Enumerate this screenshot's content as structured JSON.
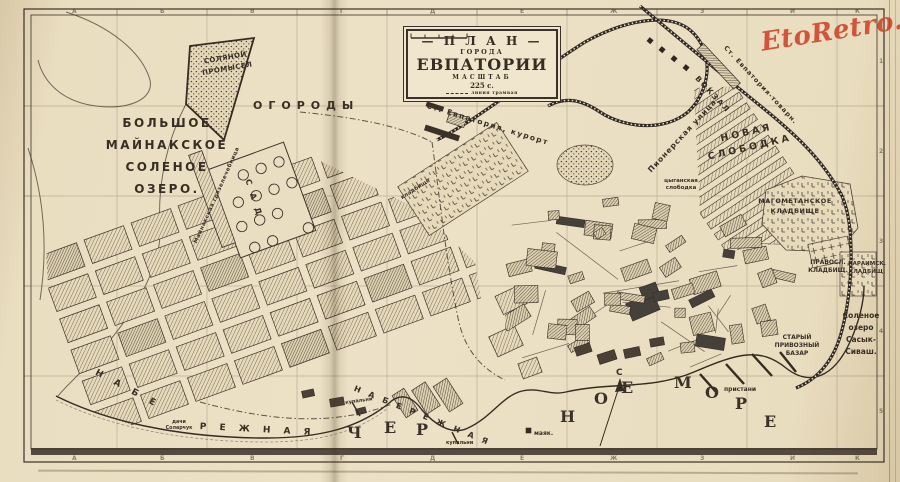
{
  "cartouche": {
    "plan": "— П Л А Н —",
    "goroda": "ГОРОДА",
    "city": "ЕВПАТОРИИ",
    "masshtab": "МАСШТАБ",
    "scale_value": "225 с.",
    "legend_tram": "линия трамвая"
  },
  "watermark": {
    "text": "EtoRetro.ru",
    "color": "#cf4a31"
  },
  "compass": {
    "north": "С"
  },
  "colors": {
    "paper": "#e9ddc0",
    "ink": "#372e23",
    "watermark": "#cf4a31"
  },
  "labels": [
    {
      "name": "lake-bolshoe-maynakskoe",
      "text": "БОЛЬШОЕ\nМАЙНАКСКОЕ\nСОЛЕНОЕ\nОЗЕРО.",
      "x": 92,
      "y": 112,
      "w": 150,
      "size": 12,
      "ls": 2.5,
      "lh": 22
    },
    {
      "name": "solyanoy-promysel",
      "text": "СОЛЯНОЙ\nПРОМЫСЕЛ",
      "x": 196,
      "y": 58,
      "w": 58,
      "size": 7,
      "ls": 0.5,
      "lh": 11,
      "rot": -10
    },
    {
      "name": "ogorody",
      "text": "ОГОРОДЫ",
      "x": 253,
      "y": 99,
      "size": 11,
      "ls": 6
    },
    {
      "name": "st-evpatoriya-kurort",
      "text": "Ст. Евпатория, курорт",
      "x": 428,
      "y": 101,
      "size": 7.5,
      "ls": 1.5,
      "rot": 17
    },
    {
      "name": "st-evpatoriya-tovarn",
      "text": "Ст. Евпатория-товарн.",
      "x": 728,
      "y": 44,
      "size": 6.5,
      "ls": 1,
      "rot": 47
    },
    {
      "name": "vokzal",
      "text": "ВОКЗАЛ",
      "x": 700,
      "y": 74,
      "size": 7.5,
      "ls": 2,
      "rot": 47
    },
    {
      "name": "pionerskaya-ulitsa",
      "text": "Пионерская улица",
      "x": 646,
      "y": 168,
      "size": 7.5,
      "ls": 1,
      "rot": -47
    },
    {
      "name": "tsyganskaya-slobodka",
      "text": "цыганская\nслободка",
      "x": 652,
      "y": 178,
      "w": 58,
      "size": 5.5,
      "lh": 7
    },
    {
      "name": "novaya-slobodka",
      "text": "НОВАЯ\nСЛОБОДКА",
      "x": 700,
      "y": 136,
      "w": 92,
      "size": 9.5,
      "ls": 3,
      "lh": 15,
      "rot": -13
    },
    {
      "name": "magometanskoe-kladbishche",
      "text": "МАГОМЕТАНСКОЕ\nКЛАДБИЩЕ",
      "x": 752,
      "y": 197,
      "w": 86,
      "size": 6.5,
      "ls": 0.5,
      "lh": 9.5
    },
    {
      "name": "pravoslavnoe-kladbishche",
      "text": "ПРАВОСЛ.\nКЛАДБИЩ.",
      "x": 806,
      "y": 259,
      "w": 44,
      "size": 6,
      "lh": 8
    },
    {
      "name": "karaimskoe-kladbishche",
      "text": "КАРАИМСК.\nКЛАДБИЩ.",
      "x": 846,
      "y": 260,
      "w": 42,
      "size": 5.5,
      "lh": 8
    },
    {
      "name": "ozero-sasyk-sivash",
      "text": "Соленое\nозеро\nСасык-\nСиваш.",
      "x": 838,
      "y": 310,
      "w": 46,
      "size": 7.5,
      "lh": 12
    },
    {
      "name": "stary-privozny-bazar",
      "text": "СТАРЫЙ\nПРИВОЗНЫЙ\nБАЗАР",
      "x": 770,
      "y": 334,
      "w": 54,
      "size": 6,
      "lh": 8
    },
    {
      "name": "sad",
      "text": "С А Д",
      "x": 252,
      "y": 178,
      "size": 8,
      "ls": 3,
      "rot": 72
    },
    {
      "name": "maynakskaya-gryazelechebnitsa",
      "text": "Майнакская грязелечебница",
      "x": 193,
      "y": 242,
      "size": 5.5,
      "ls": 0.5,
      "rot": -66
    },
    {
      "name": "naberezhnaya-west-1",
      "text": "Н А Б Е",
      "x": 98,
      "y": 368,
      "size": 9,
      "ls": 5,
      "rot": 28
    },
    {
      "name": "naberezhnaya-west-2",
      "text": "Р Е Ж Н А Я",
      "x": 200,
      "y": 422,
      "size": 9,
      "ls": 5,
      "rot": 3
    },
    {
      "name": "naberezhnaya-east",
      "text": "Н А Б Е Р Е Ж Н А Я",
      "x": 356,
      "y": 384,
      "size": 8,
      "ls": 3,
      "rot": 22
    },
    {
      "name": "kupalni-west",
      "text": "купальни",
      "x": 345,
      "y": 400,
      "size": 5,
      "rot": -8
    },
    {
      "name": "kupalni-east",
      "text": "купальни",
      "x": 446,
      "y": 440,
      "size": 5
    },
    {
      "name": "mayak",
      "text": "маяк.",
      "x": 534,
      "y": 430,
      "size": 6
    },
    {
      "name": "pristani",
      "text": "пристани",
      "x": 724,
      "y": 386,
      "size": 6
    },
    {
      "name": "dachi",
      "text": "дачи\nСоларчук",
      "x": 158,
      "y": 420,
      "w": 42,
      "size": 4.8,
      "lh": 6
    },
    {
      "name": "kladbishche-u-stantsii",
      "text": "кладбище",
      "x": 400,
      "y": 196,
      "size": 5.5,
      "rot": -33
    },
    {
      "name": "compass-north",
      "text": "С",
      "x": 616,
      "y": 368,
      "size": 9
    }
  ],
  "sea_letters": [
    {
      "ch": "Ч",
      "x": 347,
      "y": 423
    },
    {
      "ch": "Е",
      "x": 384,
      "y": 418
    },
    {
      "ch": "Р",
      "x": 416,
      "y": 420
    },
    {
      "ch": "Н",
      "x": 560,
      "y": 407
    },
    {
      "ch": "О",
      "x": 594,
      "y": 389
    },
    {
      "ch": "Е",
      "x": 621,
      "y": 378
    },
    {
      "ch": "М",
      "x": 674,
      "y": 373
    },
    {
      "ch": "О",
      "x": 705,
      "y": 383
    },
    {
      "ch": "Р",
      "x": 735,
      "y": 394
    },
    {
      "ch": "Е",
      "x": 764,
      "y": 412
    }
  ],
  "grid": {
    "top_letters": [
      "А",
      "Б",
      "В",
      "Г",
      "Д",
      "Е",
      "Ж",
      "З",
      "И",
      "К"
    ],
    "bottom_letters": [
      "А",
      "Б",
      "В",
      "Г",
      "Д",
      "Е",
      "Ж",
      "З",
      "И",
      "К"
    ],
    "right_numbers": [
      "1",
      "2",
      "3",
      "4",
      "5"
    ]
  }
}
